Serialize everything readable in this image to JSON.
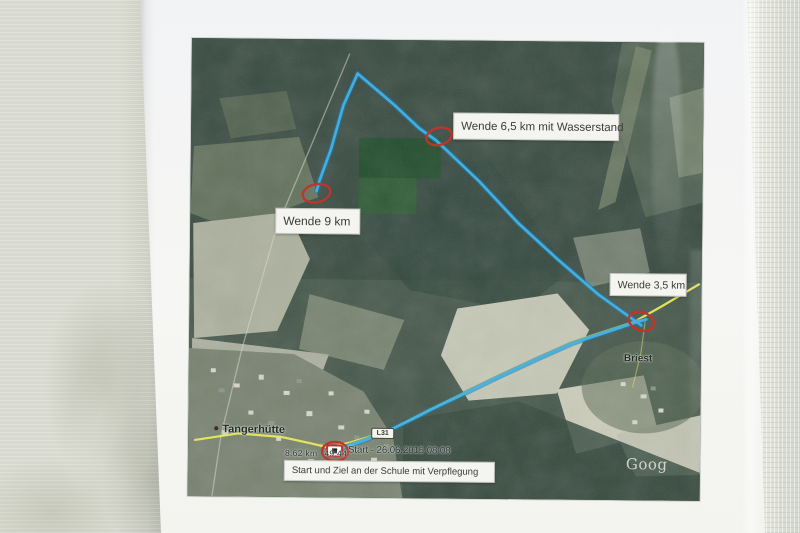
{
  "photo": {
    "scene": "Printed satellite course map on white paper inside a clear plastic sleeve on a wall"
  },
  "map": {
    "annotations": {
      "turn_65": "Wende 6,5 km mit Wasserstand",
      "turn_9": "Wende 9 km",
      "turn_35": "Wende 3,5 km",
      "start_finish": "Start und Ziel an der Schule mit Verpflegung"
    },
    "places": {
      "town": "Tangerhütte",
      "village": "Briest",
      "road_badge": "L31"
    },
    "gps": {
      "start_label": "Start - 26.06.2015 08:08",
      "distance": "8.62 km",
      "time": "49:44"
    },
    "watermark": "Goog",
    "colors": {
      "track_blue": "#45b3e6",
      "road_yellow": "#e8e95e",
      "annotation_red": "#c0342b",
      "note_background": "#f4f4f1",
      "forest_dark": "#35483e",
      "field_light": "#c6c8b6"
    }
  }
}
